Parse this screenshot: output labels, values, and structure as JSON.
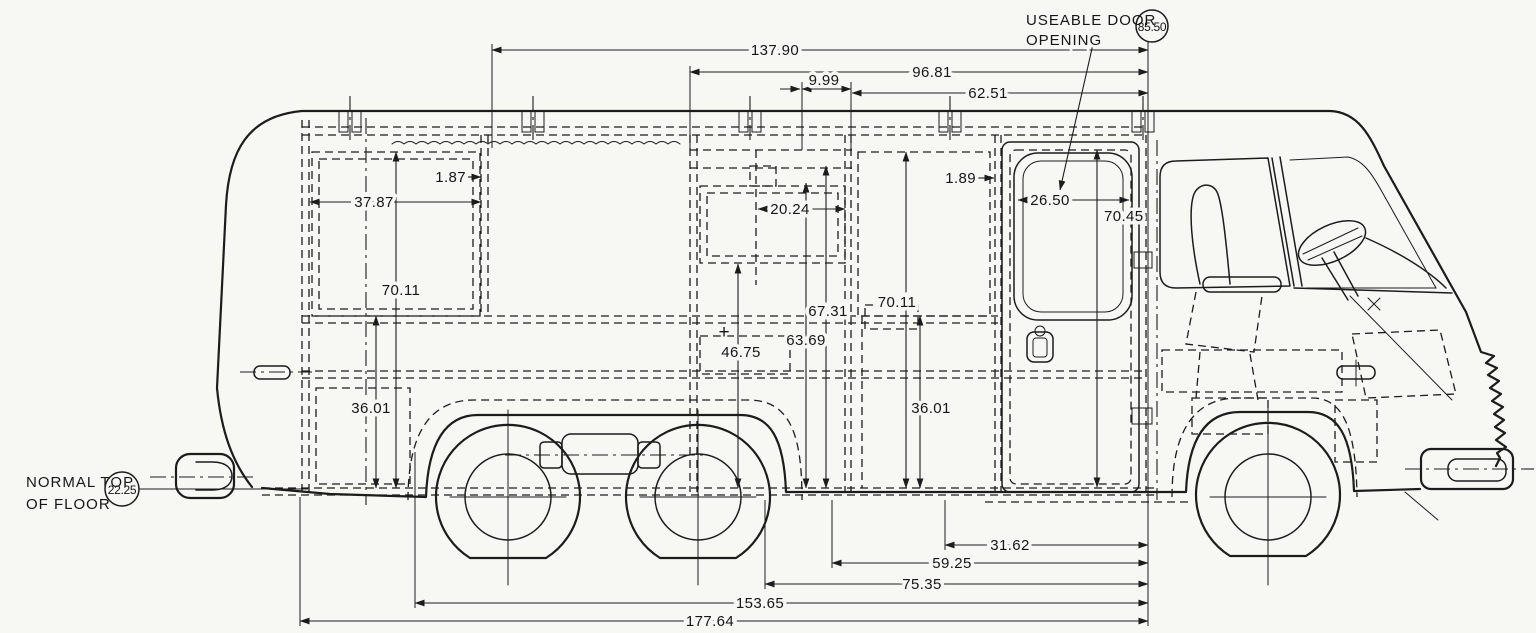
{
  "drawing": {
    "callouts": {
      "useable_door_line1": "USEABLE DOOR",
      "useable_door_line2": "OPENING",
      "floor_label_line1": "NORMAL TOP",
      "floor_label_line2": "OF FLOOR",
      "door_opening_circle": "85.50",
      "floor_circle": "22.25",
      "plus_marker": "+"
    },
    "dimensions": {
      "top": {
        "d137_90": "137.90",
        "d96_81": "96.81",
        "d9_99": "9.99",
        "d62_51": "62.51"
      },
      "interior": {
        "d1_87": "1.87",
        "d37_87": "37.87",
        "d70_11_rear": "70.11",
        "d36_01_rear": "36.01",
        "d20_24": "20.24",
        "d67_31": "67.31",
        "d63_69": "63.69",
        "d46_75": "46.75",
        "d70_11_front": "70.11",
        "d36_01_front": "36.01",
        "d1_89": "1.89",
        "d26_50": "26.50",
        "d70_45": "70.45"
      },
      "bottom": {
        "d31_62": "31.62",
        "d59_25": "59.25",
        "d75_35": "75.35",
        "d153_65": "153.65",
        "d177_64": "177.64"
      }
    },
    "colors": {
      "ink": "#1c1c1c",
      "paper": "#f7f7f4"
    }
  }
}
